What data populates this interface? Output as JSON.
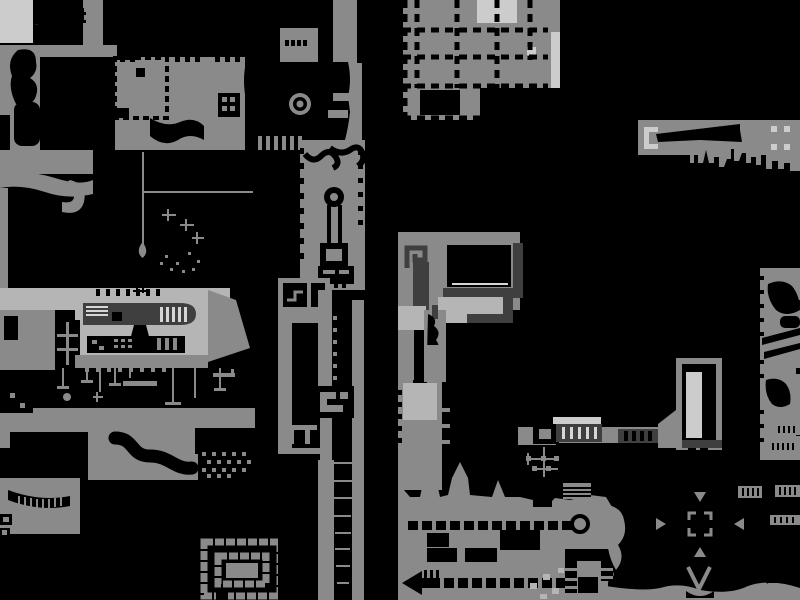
{
  "canvas": {
    "width": 800,
    "height": 600
  },
  "colors": {
    "background": "#000000",
    "terrain": "#8a8a8a",
    "light": "#b5b5b5",
    "lighter": "#cccccc",
    "dark": "#3f3f3f",
    "stripe_light": "#d6d6d6"
  },
  "map": {
    "description": "monochrome cave world map",
    "markers": [
      {
        "name": "boss-eye"
      },
      {
        "name": "ring-beacon"
      },
      {
        "name": "target-brackets"
      },
      {
        "name": "direction-arrow-down"
      },
      {
        "name": "direction-arrow-right"
      },
      {
        "name": "direction-arrow-left"
      },
      {
        "name": "direction-arrow-up"
      },
      {
        "name": "checkpoint-v"
      },
      {
        "name": "item-brackets"
      },
      {
        "name": "spiral-maze"
      },
      {
        "name": "keyhole-door"
      },
      {
        "name": "teardrop"
      },
      {
        "name": "spike-arrow-left"
      }
    ]
  }
}
